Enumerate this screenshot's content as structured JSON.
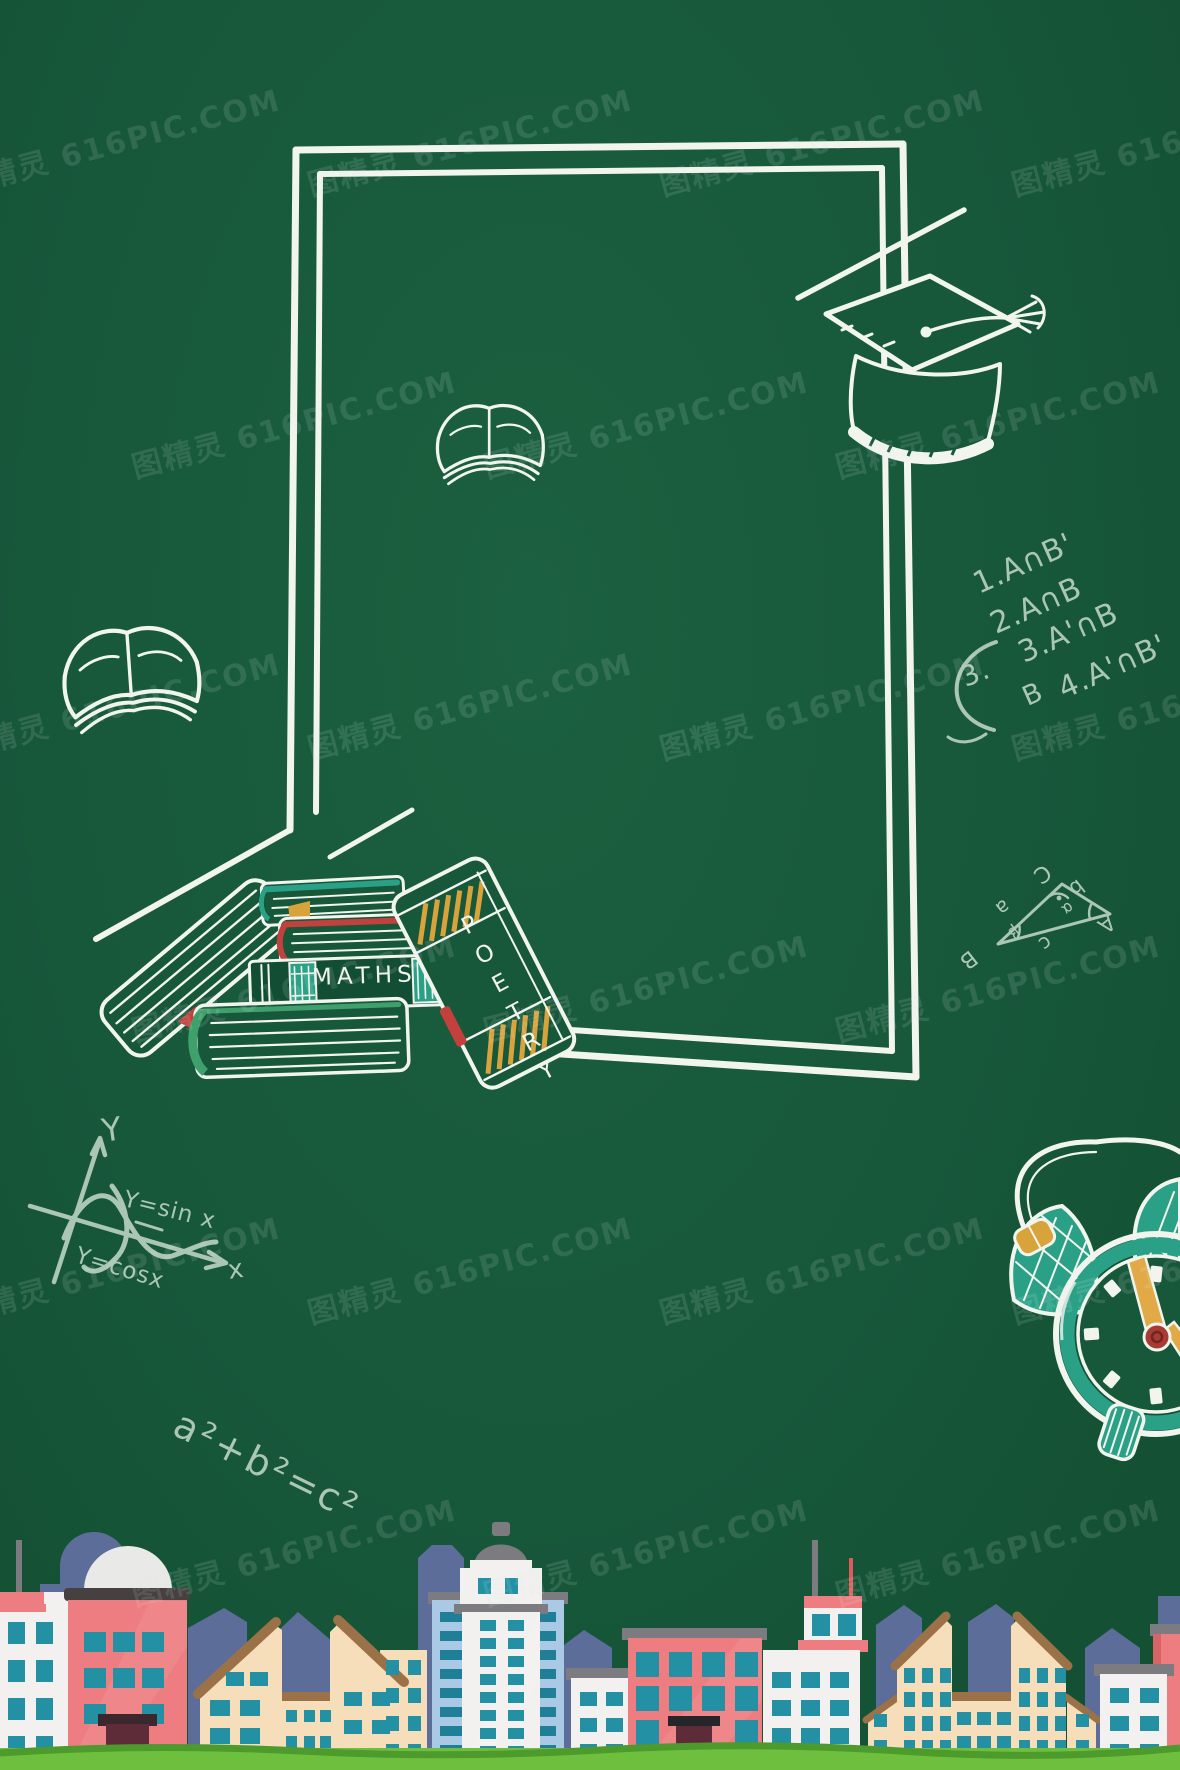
{
  "watermark": {
    "text": "图精灵 616PIC.COM",
    "rows": 6,
    "cols": 4,
    "x_start": -50,
    "y_start": 118,
    "row_step": 282,
    "col_step": 352,
    "stagger": 176,
    "rotation_deg": -15,
    "opacity": 0.13,
    "font_size": 30
  },
  "palette": {
    "board_green": "#17573a",
    "chalk_white": "#f2f4ee",
    "chalk_pale": "#abc6b4",
    "teal": "#2aa187",
    "window_teal": "#2391a3",
    "book_red": "#c2413d",
    "gold": "#d9a33c",
    "leaf_green": "#3fa06b",
    "spine_green": "#124e33",
    "slate": "#5d6d99",
    "pink": "#ee7d81",
    "pink_deep": "#d96468",
    "cream": "#f6deba",
    "roof_brown": "#9b7148",
    "dark_band": "#474041",
    "maroon": "#5e2c38",
    "white_bldg": "#f2f1ef",
    "light_blue": "#aac9e4",
    "gray_cap": "#7b7b80",
    "dome_gray": "#e9e9e7",
    "clock_red": "#a83c35",
    "hand_gold": "#e2aa46",
    "grass": "#6fbf3f",
    "grass_dark": "#4d9a2d",
    "antenna_red": "#e05a5a"
  },
  "chalk": {
    "set_list": {
      "l1": "1.A∩B'",
      "l2": "2.A∩B",
      "l3": "3.A'∩B",
      "l4": "4.A'∩B'"
    },
    "arc_number": "3.",
    "arc_b_label": "B",
    "pythagoras": "a²+b²=c²",
    "graph": {
      "y_axis": "Y",
      "x_axis": "x",
      "sin": "Y=sin x",
      "cos": "Y=cosx"
    },
    "triangle": {
      "v_a": "A",
      "v_b": "B",
      "v_c": "C",
      "s_a": "a",
      "s_b": "b",
      "s_c": "c",
      "ang_a": "α",
      "ang_b": "β"
    }
  },
  "books": {
    "maths": "MATHS",
    "poetry": "POETRY"
  }
}
